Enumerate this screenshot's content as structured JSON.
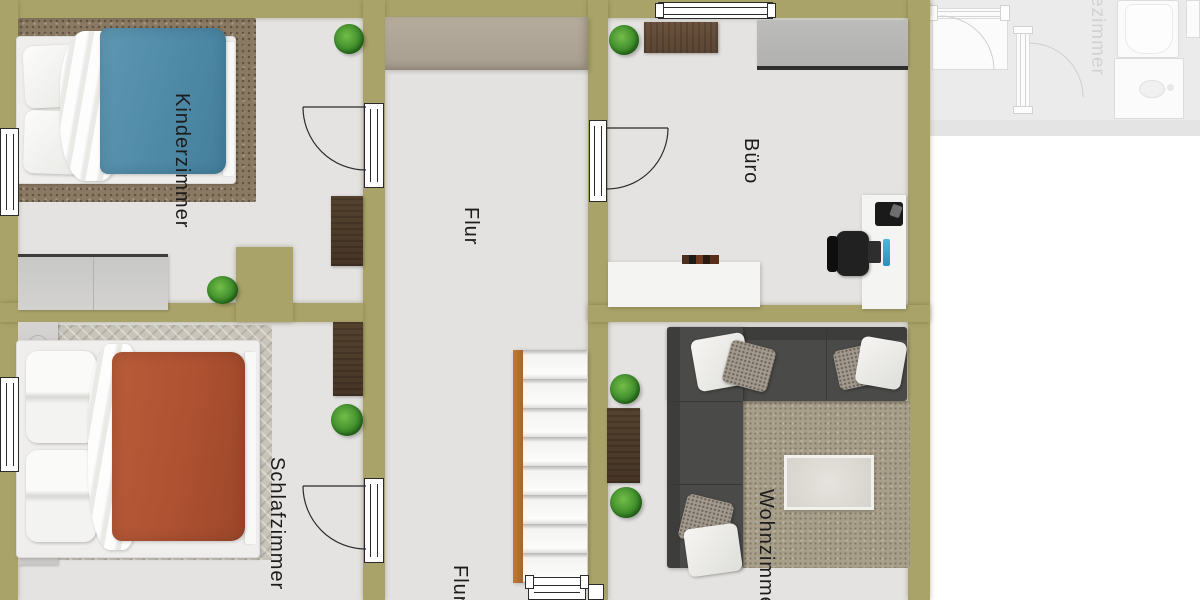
{
  "plan": {
    "type": "floorplan",
    "labels": {
      "kinderzimmer": "Kinderzimmer",
      "schlafzimmer": "Schlafzimmer",
      "flur_upper": "Flur",
      "flur_lower": "Flur",
      "buero": "Büro",
      "wohnzimmer": "Wohnzimmer",
      "adjacent_plan_fragment": "ezimmer"
    },
    "rooms": [
      {
        "label": "Kinderzimmer",
        "furniture": [
          "single-bed-blue",
          "rug-brown",
          "desk-wood",
          "dresser-gray",
          "plant",
          "plant"
        ]
      },
      {
        "label": "Schlafzimmer",
        "furniture": [
          "double-bed-red",
          "rug-herringbone",
          "nightstand",
          "nightstand",
          "wardrobe-wood",
          "plant"
        ]
      },
      {
        "label": "Flur",
        "furniture": [
          "wardrobe-taupe",
          "staircase"
        ]
      },
      {
        "label": "Büro",
        "furniture": [
          "desk-wood",
          "cabinet-gray",
          "sideboard-white",
          "books",
          "pc-desk",
          "office-chair",
          "plant"
        ]
      },
      {
        "label": "Wohnzimmer",
        "furniture": [
          "corner-sofa",
          "rug-beige",
          "coffee-table",
          "shelf-wood",
          "plant",
          "plant"
        ]
      }
    ],
    "colors": {
      "wall": "#a9a369",
      "floor": "#e4e3e1",
      "kinder_rug": "#8a7963",
      "kinder_blanket": "#4e89a6",
      "schlaf_rug": "#c8c4ba",
      "schlaf_blanket": "#ad5132",
      "wood_furniture": "#5f4a38",
      "flur_wardrobe": "#b1a799",
      "buero_cabinet": "#b7b7b6",
      "sofa": "#4a4a48",
      "wohn_rug": "#a89f8b",
      "stairs_stringer": "#b06f2e",
      "plant": "#3e8c2b",
      "monitor_accent": "#3aa5d6",
      "ghost_plan": "#ebebeb"
    }
  }
}
